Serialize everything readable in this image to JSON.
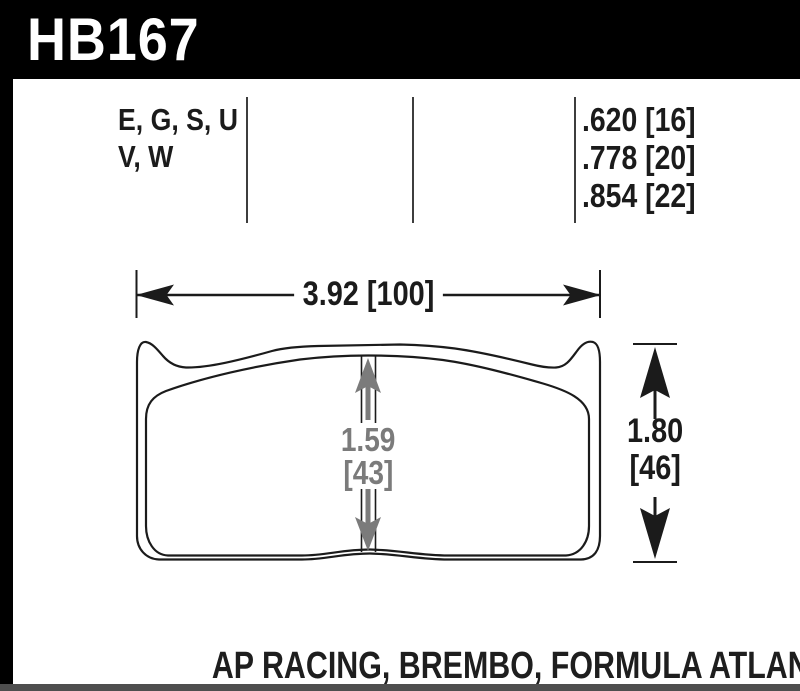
{
  "part_header": {
    "part_number": "HB167"
  },
  "spec_columns": {
    "compounds": {
      "line1": "E, G, S, U",
      "line2": "V, W"
    },
    "thicknesses": {
      "row1": ".620 [16]",
      "row2": ".778 [20]",
      "row3": ".854 [22]"
    }
  },
  "dimensions": {
    "width": "3.92 [100]",
    "height_in": "1.80",
    "height_mm": "[46]",
    "pad_center_in": "1.59",
    "pad_center_mm": "[43]"
  },
  "caption": "AP RACING, BREMBO, FORMULA ATLANTIC",
  "colors": {
    "header_bg": "#000000",
    "header_text": "#ffffff",
    "line_art": "#1b1b1b",
    "divider": "#3e3e3e",
    "dim_gray": "#7b7b7b",
    "bottom_bar": "#4e4e4e"
  }
}
